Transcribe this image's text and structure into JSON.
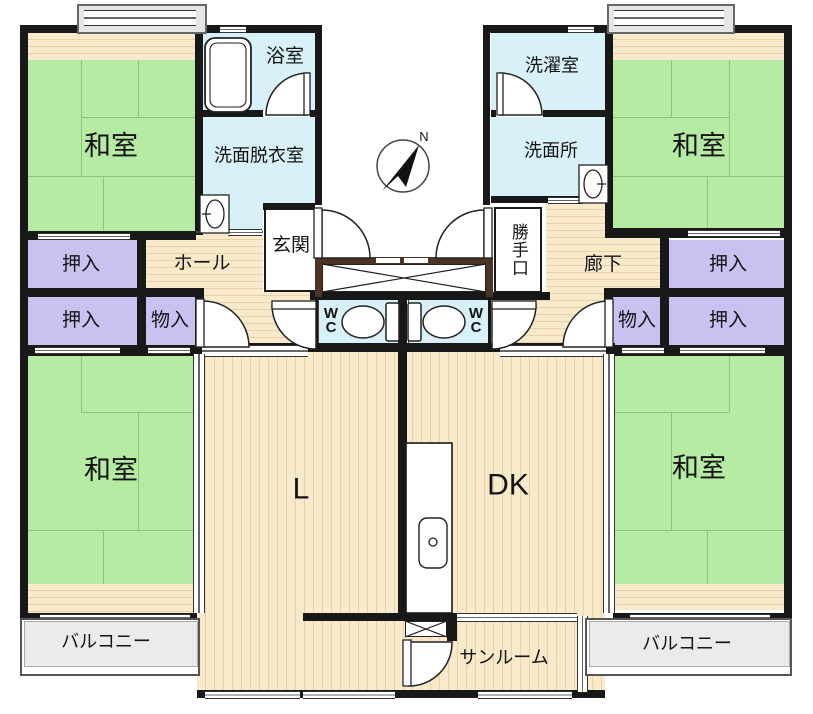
{
  "plan_title": "apartment-floor-plan",
  "compass": {
    "north_label": "N"
  },
  "rooms": {
    "washitsu_tl": "和室",
    "washitsu_tr": "和室",
    "washitsu_bl": "和室",
    "washitsu_br": "和室",
    "bath": "浴室",
    "washroom_dressing": "洗面脱衣室",
    "laundry": "洗濯室",
    "washroom": "洗面所",
    "entrance": "玄関",
    "back_door": "勝手口",
    "hall": "ホール",
    "corridor": "廊下",
    "closet_tl1": "押入",
    "closet_tl2": "押入",
    "storage_l": "物入",
    "closet_tr1": "押入",
    "closet_tr2": "押入",
    "storage_r": "物入",
    "wc_l": "WC",
    "wc_r": "WC",
    "living": "L",
    "dining_kitchen": "DK",
    "sunroom": "サンルーム",
    "balcony_l": "バルコニー",
    "balcony_r": "バルコニー"
  },
  "colors": {
    "tatami_green": "#b6eba3",
    "wood_floor": "#f9eacb",
    "wood_line": "#e8d2a7",
    "water_blue": "#d8f0f8",
    "closet_purple": "#c7c2ef",
    "balcony_gray": "#ebebeb",
    "wall_black": "#181818",
    "step_brown": "#4b3425"
  }
}
